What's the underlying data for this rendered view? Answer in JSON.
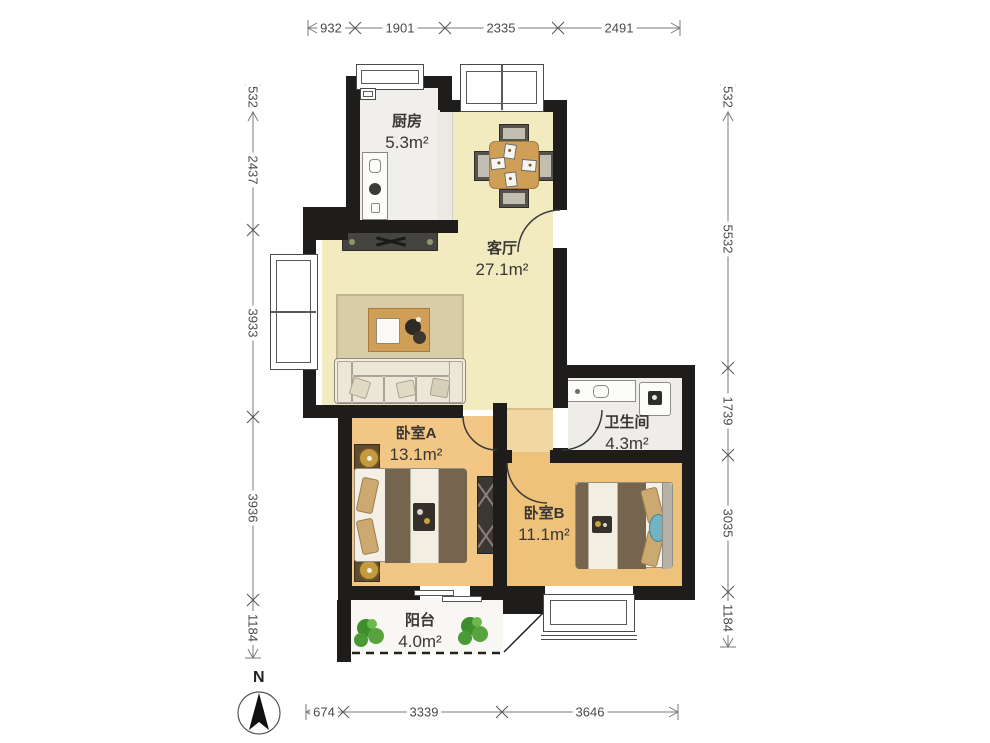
{
  "compass": {
    "label": "N"
  },
  "rooms": {
    "kitchen": {
      "name": "厨房",
      "area": "5.3m²"
    },
    "living": {
      "name": "客厅",
      "area": "27.1m²"
    },
    "bedroomA": {
      "name": "卧室A",
      "area": "13.1m²"
    },
    "bathroom": {
      "name": "卫生间",
      "area": "4.3m²"
    },
    "bedroomB": {
      "name": "卧室B",
      "area": "11.1m²"
    },
    "balcony": {
      "name": "阳台",
      "area": "4.0m²"
    }
  },
  "dimensions": {
    "top": [
      "932",
      "1901",
      "2335",
      "2491"
    ],
    "bottom": [
      "674",
      "3339",
      "3646"
    ],
    "left": [
      "532",
      "2437",
      "3933",
      "3936",
      "1184"
    ],
    "right": [
      "532",
      "5532",
      "1739",
      "3035",
      "1184"
    ]
  },
  "colors": {
    "wall": "#1e1d1b",
    "living_floor": "#f3ebc0",
    "bedroomA_floor": "#f2c785",
    "bedroomB_floor": "#eec27a",
    "kitchen_floor": "#f0efeb",
    "bathroom_floor": "#eeedea",
    "balcony_floor": "#f8f7f3",
    "wood_accent": "#cf9f58",
    "blanket": "#75654f",
    "teal_pillow": "#72b4c4",
    "plant_green": "#4a9a35",
    "dimension_text": "#4a4a4a"
  }
}
